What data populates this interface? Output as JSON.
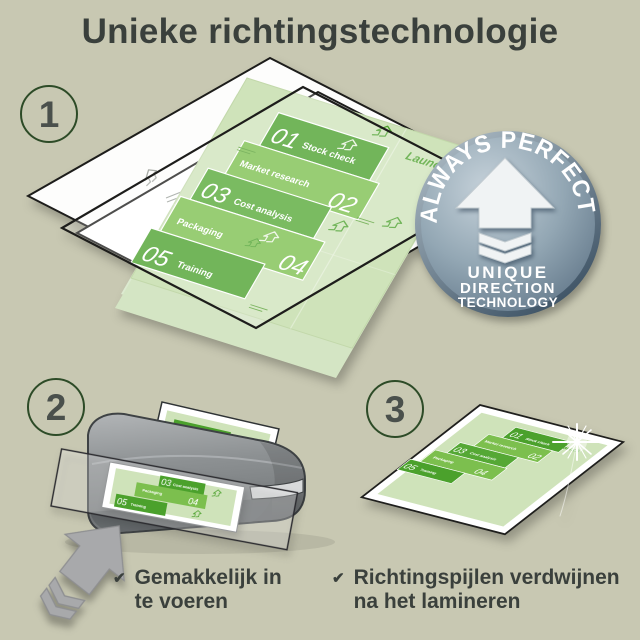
{
  "title": "Unieke richtingstechnologie",
  "steps": {
    "step1": "1",
    "step2": "2",
    "step3": "3"
  },
  "badge": {
    "arc": "ALWAYS PERFECT!",
    "line1": "UNIQUE",
    "line2": "DIRECTION",
    "line3": "TECHNOLOGY"
  },
  "doc": {
    "launch": "Launch",
    "items": [
      {
        "num": "01",
        "label": "Stock check"
      },
      {
        "num": "02",
        "label": "Market research"
      },
      {
        "num": "03",
        "label": "Cost analysis"
      },
      {
        "num": "04",
        "label": "Packaging"
      },
      {
        "num": "05",
        "label": "Training"
      }
    ]
  },
  "bullets": [
    {
      "check": "✔",
      "line1": "Gemakkelijk in",
      "line2": "te voeren"
    },
    {
      "check": "✔",
      "line1": "Richtingspijlen verdwijnen",
      "line2": "na het lamineren"
    }
  ],
  "colors": {
    "background": "#c8c8b2",
    "text": "#3a403c",
    "green_dark": "#4ba12c",
    "green_mid": "#7cbf4e",
    "doc_background": "#cfe3ba",
    "badge_face": "#8ba0af",
    "circle_ring": "#2d4b27"
  }
}
